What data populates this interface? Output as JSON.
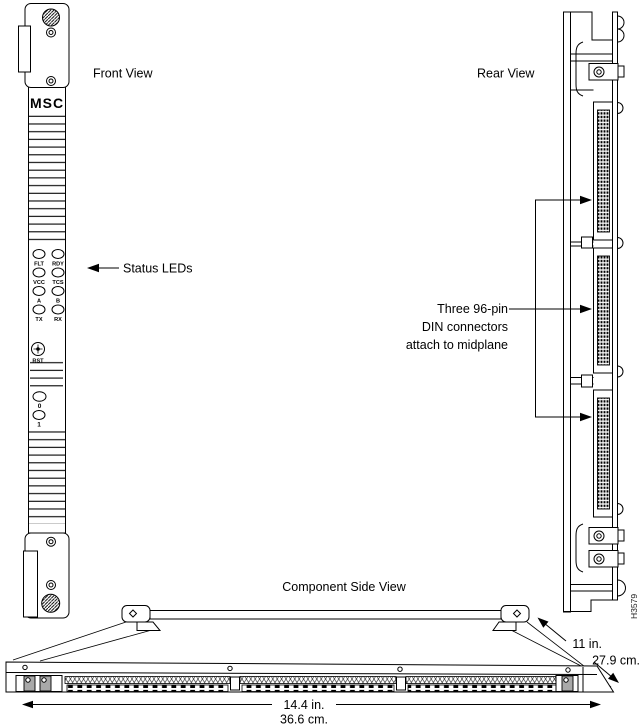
{
  "figure": {
    "front_view_label": "Front View",
    "rear_view_label": "Rear View",
    "component_view_label": "Component Side View",
    "figure_number": "H3579"
  },
  "front_panel": {
    "card_name": "MSC",
    "status_callout": "Status LEDs",
    "leds": [
      {
        "label": "FLT"
      },
      {
        "label": "RDY"
      },
      {
        "label": "VCC"
      },
      {
        "label": "TCS"
      },
      {
        "label": "A"
      },
      {
        "label": "B"
      },
      {
        "label": "TX"
      },
      {
        "label": "RX"
      }
    ],
    "reset_button_label": "RST",
    "ports": [
      {
        "label": "0"
      },
      {
        "label": "1"
      }
    ]
  },
  "rear_panel": {
    "connector_note": [
      "Three 96-pin",
      "DIN connectors",
      "attach to midplane"
    ]
  },
  "dimensions": {
    "width_label_in": "14.4 in.",
    "width_label_cm": "36.6 cm.",
    "depth_label_in": "11 in.",
    "depth_label_cm": "27.9 cm."
  }
}
